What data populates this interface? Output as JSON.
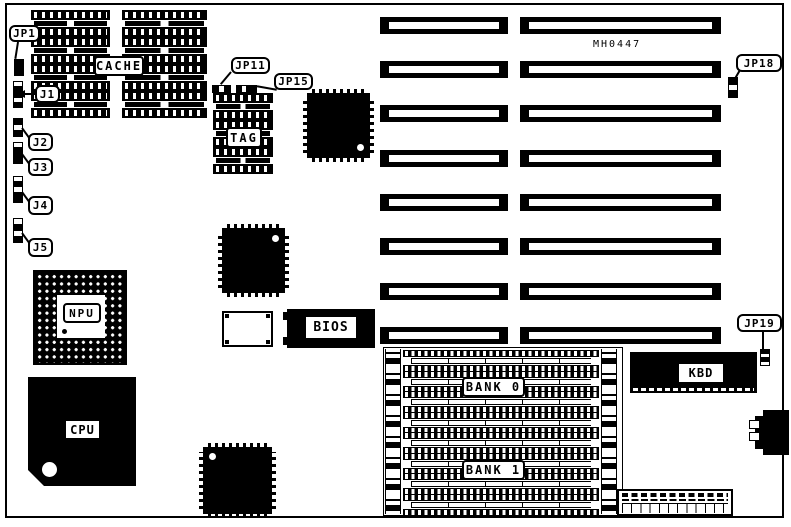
{
  "board": {
    "part_number": "MH0447",
    "ink_color": "#000000",
    "paper_color": "#ffffff",
    "callouts": {
      "jp1": "JP1",
      "j1": "J1",
      "j2": "J2",
      "j3": "J3",
      "j4": "J4",
      "j5": "J5",
      "jp11": "JP11",
      "jp15": "JP15",
      "jp18": "JP18",
      "jp19": "JP19"
    },
    "components": {
      "cache": "CACHE",
      "tag": "TAG",
      "npu": "NPU",
      "cpu": "CPU",
      "bios": "BIOS",
      "kbd": "KBD",
      "bank0": "BANK 0",
      "bank1": "BANK 1"
    }
  }
}
